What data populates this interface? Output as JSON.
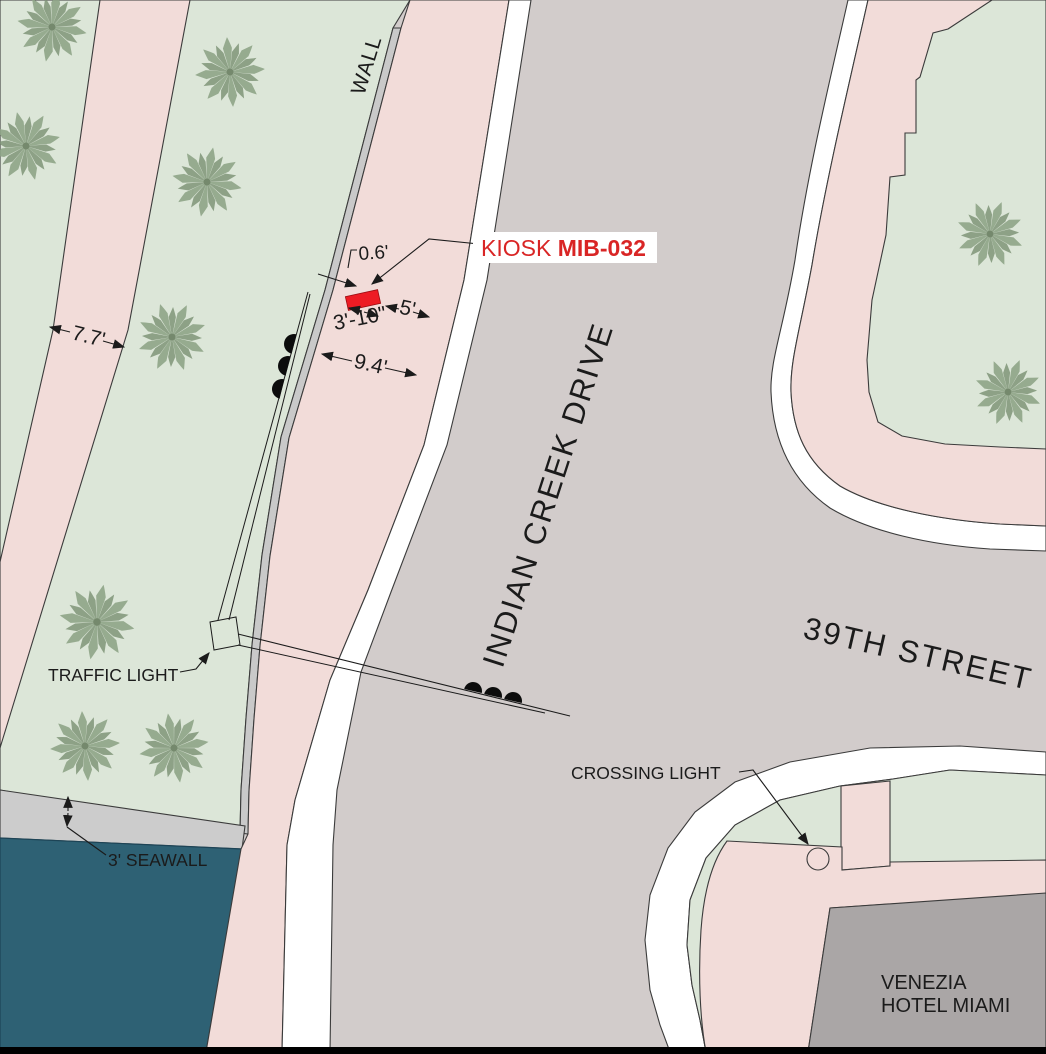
{
  "streets": {
    "indian_creek_drive": "INDIAN CREEK DRIVE",
    "thirty_ninth_street": "39TH STREET"
  },
  "kiosk": {
    "label_prefix": "KIOSK ",
    "label_id": "MIB-032"
  },
  "labels": {
    "wall": "WALL",
    "traffic_light": "TRAFFIC LIGHT",
    "crossing_light": "CROSSING LIGHT",
    "seawall": "3' SEAWALL",
    "hotel_line1": "VENEZIA",
    "hotel_line2": "HOTEL MIAMI"
  },
  "dimensions": {
    "kiosk_to_wall": "0.6'",
    "kiosk_width": "3'-10\"",
    "kiosk_clearance": "5'",
    "sidewalk_width": "9.4'",
    "path_width": "7.7'"
  },
  "colors": {
    "road": "#d2cccb",
    "park_green": "#dce6d8",
    "walkway_pink": "#f2dcd9",
    "curb_white": "#ffffff",
    "wall_gray": "#c9c9c9",
    "seawall_gray": "#cccccc",
    "water_teal": "#2e6174",
    "hotel_gray": "#aaa6a6",
    "kiosk_red": "#ed1c24",
    "label_red": "#d92525",
    "ink": "#1b1b1b",
    "border_black": "#000000"
  }
}
